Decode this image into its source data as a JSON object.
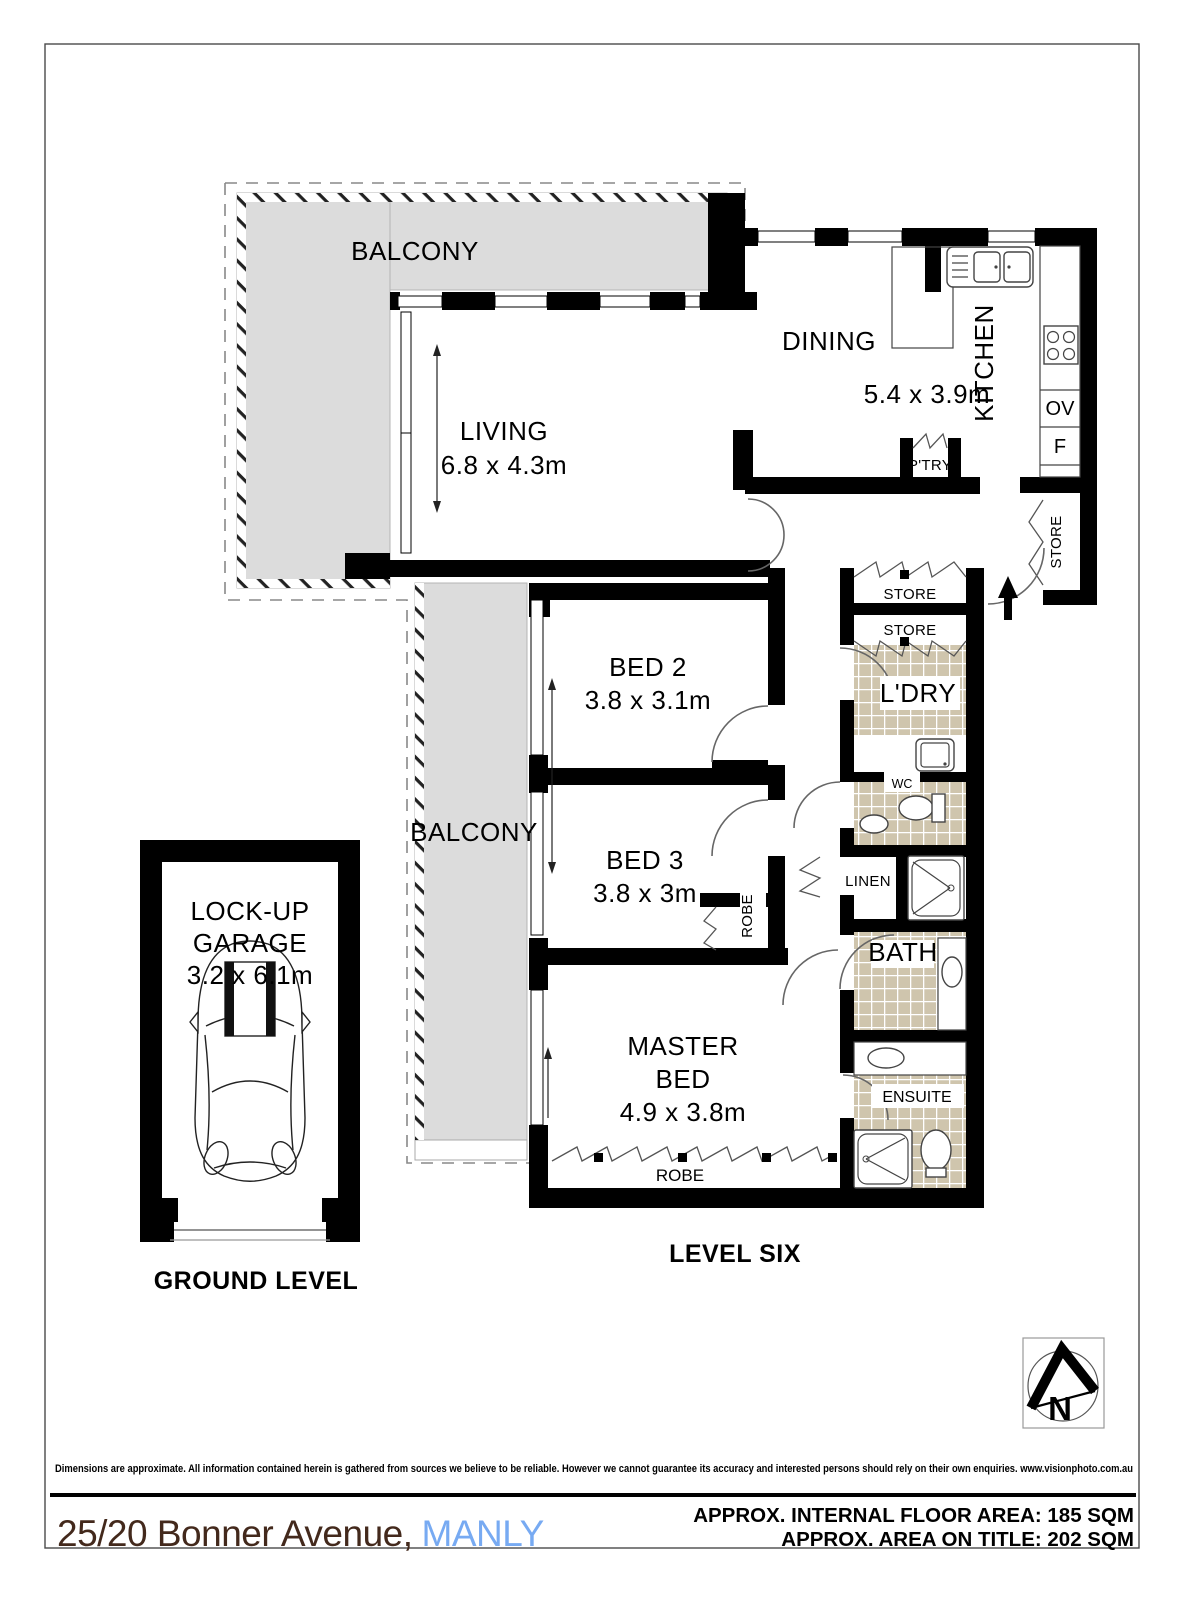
{
  "plan": {
    "level_label": "LEVEL SIX",
    "ground_label": "GROUND LEVEL",
    "balcony_top": "BALCONY",
    "balcony_side": "BALCONY",
    "living": {
      "name": "LIVING",
      "dims": "6.8 x 4.3m"
    },
    "dining": {
      "name": "DINING",
      "dims": "5.4 x 3.9m"
    },
    "kitchen": {
      "name": "KITCHEN",
      "oven": "OV",
      "fridge": "F"
    },
    "pantry": "P'TRY",
    "store_entry": "STORE",
    "store1": "STORE",
    "store2": "STORE",
    "laundry": "L'DRY",
    "wc": "WC",
    "linen": "LINEN",
    "bath": "BATH",
    "ensuite": "ENSUITE",
    "bed2": {
      "name": "BED 2",
      "dims": "3.8 x 3.1m"
    },
    "bed3": {
      "name": "BED 3",
      "dims": "3.8 x 3m"
    },
    "robe_bed3": "ROBE",
    "robe_master": "ROBE",
    "master": {
      "line1": "MASTER",
      "line2": "BED",
      "dims": "4.9 x 3.8m"
    },
    "garage": {
      "line1": "LOCK-UP",
      "line2": "GARAGE",
      "dims": "3.2 x 6.1m"
    }
  },
  "compass": {
    "letter": "N"
  },
  "footer": {
    "disclaimer": "Dimensions are approximate. All information contained herein is gathered from sources we believe to be reliable. However we cannot guarantee its accuracy and interested persons should rely on their own enquiries. www.visionphoto.com.au",
    "address": "25/20 Bonner Avenue,",
    "suburb": "MANLY",
    "area_line1": "APPROX. INTERNAL FLOOR AREA: 185 SQM",
    "area_line2": "APPROX.  AREA ON TITLE: 202 SQM"
  },
  "colors": {
    "balcony_fill": "#dcdcdc",
    "tile_fill": "#cfc5ad",
    "address": "#43291c",
    "suburb": "#77aaf2"
  }
}
